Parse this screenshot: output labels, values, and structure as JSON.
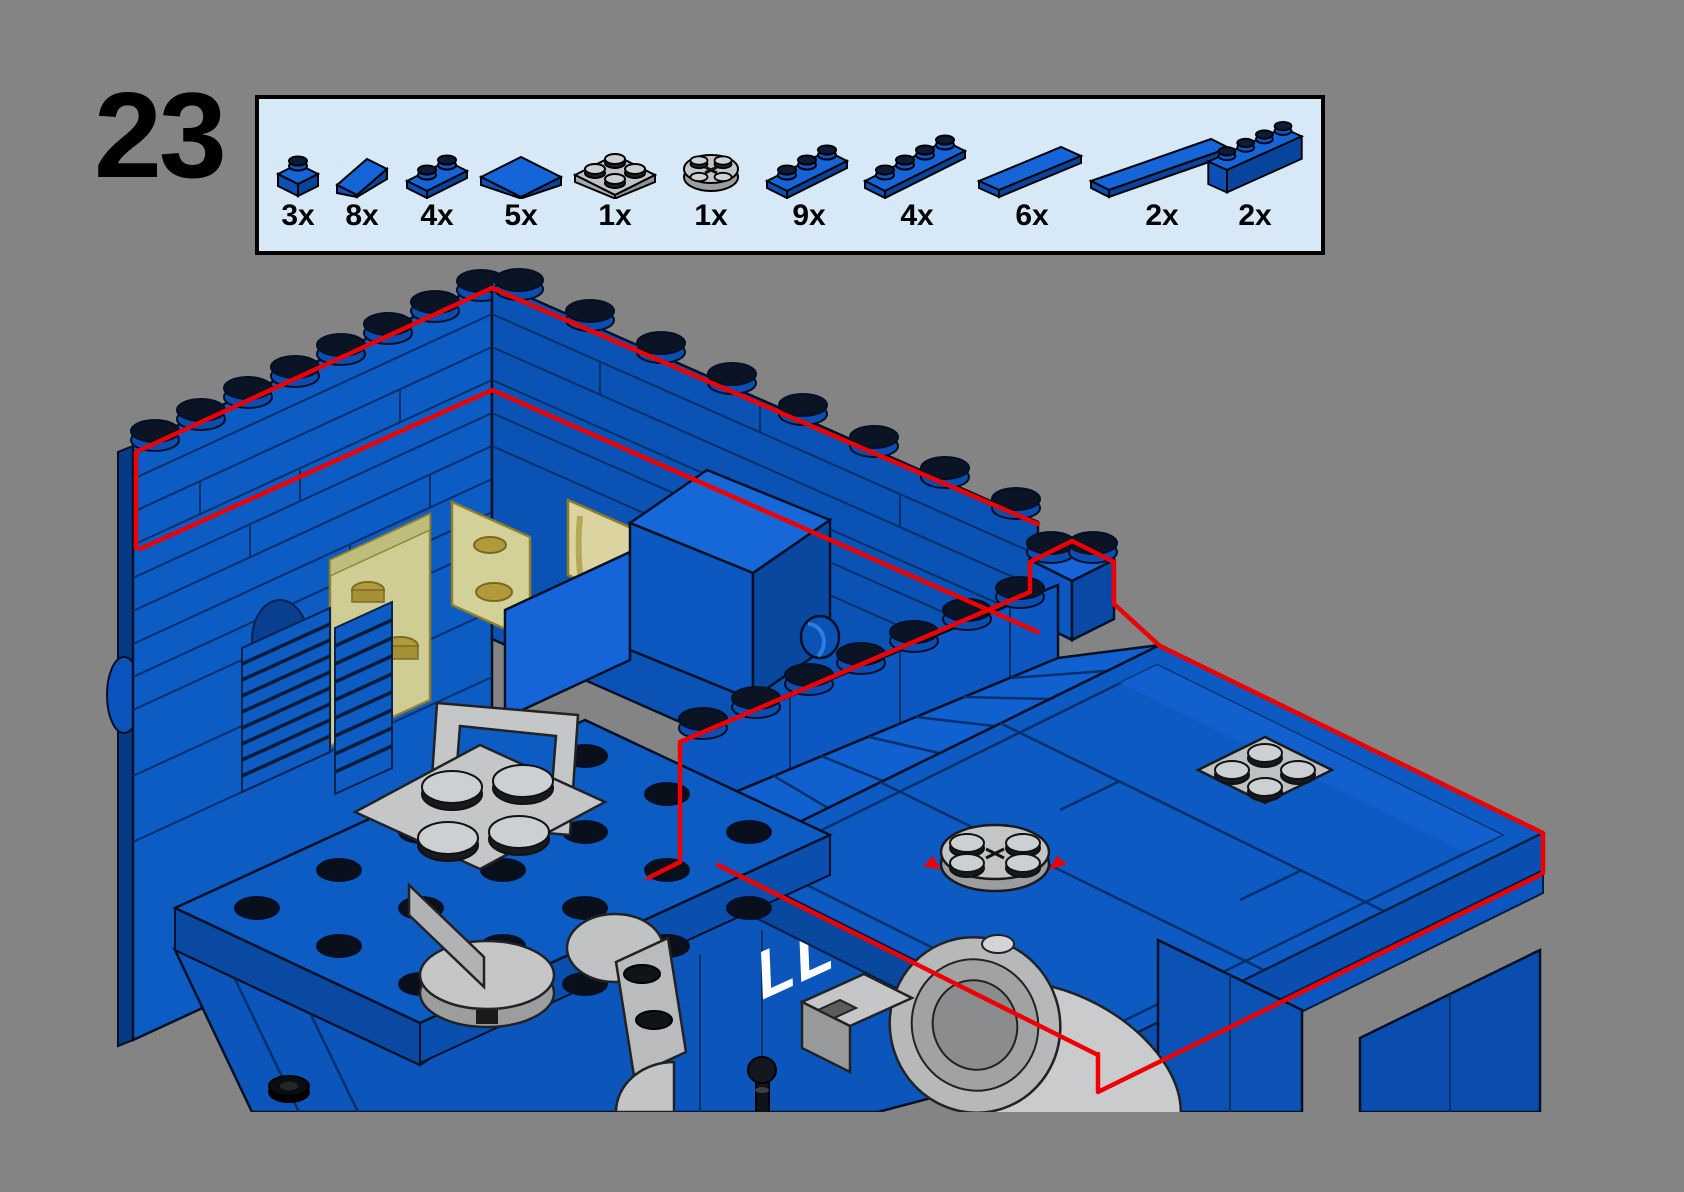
{
  "page": {
    "background_color": "#848484"
  },
  "step": {
    "number": "23"
  },
  "parts_box": {
    "fill_color": "#d7e9f7",
    "border_color": "#000000",
    "parts": [
      {
        "qty": "3x",
        "part": "1x1 plate",
        "color": "blue"
      },
      {
        "qty": "8x",
        "part": "1x2 slope 45",
        "color": "blue"
      },
      {
        "qty": "4x",
        "part": "1x2 plate",
        "color": "blue"
      },
      {
        "qty": "5x",
        "part": "2x2 tile",
        "color": "blue"
      },
      {
        "qty": "1x",
        "part": "2x2 plate",
        "color": "light-gray"
      },
      {
        "qty": "1x",
        "part": "2x2 round plate",
        "color": "light-gray"
      },
      {
        "qty": "9x",
        "part": "1x3 plate",
        "color": "blue"
      },
      {
        "qty": "4x",
        "part": "1x4 plate",
        "color": "blue"
      },
      {
        "qty": "6x",
        "part": "1x4 tile",
        "color": "blue"
      },
      {
        "qty": "2x",
        "part": "1x6 tile",
        "color": "blue"
      },
      {
        "qty": "2x",
        "part": "1x4 brick",
        "color": "blue"
      }
    ]
  },
  "illustration": {
    "hull_marking": "LL 92",
    "highlight_color": "#ef0000",
    "brick_blue": "#0b54bd",
    "brick_blue_light": "#1565d8",
    "brick_blue_dark": "#08449c",
    "gray_part_color": "#bfc1c3",
    "window_yellow": "#e7dda2"
  }
}
